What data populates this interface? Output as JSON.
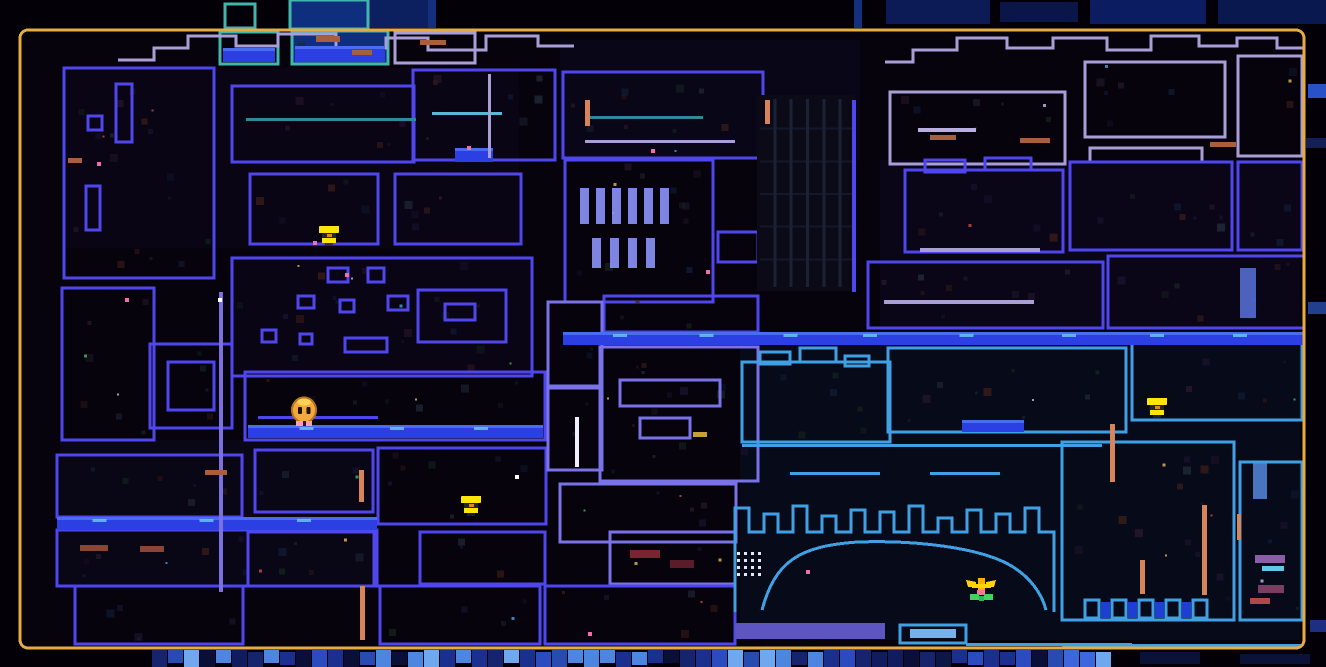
{
  "canvas": {
    "w": 1326,
    "h": 667,
    "bg_outside": "#030107",
    "bg_inside": "#07030d"
  },
  "frame": {
    "x": 20,
    "y": 30,
    "w": 1284,
    "h": 618,
    "radius": 8,
    "color": "#e7ac3f",
    "thickness": 3
  },
  "palette": {
    "b": "#4f46ee",
    "v": "#7a72e8",
    "l": "#a89fd6",
    "c": "#3fa0e4",
    "t": "#42b5ad",
    "water": "#2336d8",
    "water_band": "#2b3fe2",
    "sparkle": "#6fd4f0",
    "pipe": "#d8845a",
    "white_line": "#eef0ff",
    "purple_line": "#7a70e0"
  },
  "washes": [
    {
      "x": 560,
      "y": 40,
      "w": 300,
      "h": 120,
      "c": "#0a0a20",
      "o": 0.55
    },
    {
      "x": 880,
      "y": 160,
      "w": 420,
      "h": 170,
      "c": "#0c0a22",
      "o": 0.55
    },
    {
      "x": 60,
      "y": 440,
      "w": 320,
      "h": 150,
      "c": "#0c0a20",
      "o": 0.5
    },
    {
      "x": 740,
      "y": 345,
      "w": 560,
      "h": 295,
      "c": "#081024",
      "o": 0.55
    },
    {
      "x": 230,
      "y": 255,
      "w": 300,
      "h": 120,
      "c": "#0b081e",
      "o": 0.5
    },
    {
      "x": 64,
      "y": 68,
      "w": 455,
      "h": 180,
      "c": "#0b071c",
      "o": 0.5
    }
  ],
  "rooms": [
    {
      "x": 64,
      "y": 68,
      "w": 150,
      "h": 210,
      "c": "b"
    },
    {
      "x": 116,
      "y": 84,
      "w": 16,
      "h": 58,
      "c": "b"
    },
    {
      "x": 88,
      "y": 116,
      "w": 14,
      "h": 14,
      "c": "b"
    },
    {
      "x": 86,
      "y": 186,
      "w": 14,
      "h": 44,
      "c": "b"
    },
    {
      "x": 232,
      "y": 86,
      "w": 182,
      "h": 76,
      "c": "b"
    },
    {
      "x": 413,
      "y": 70,
      "w": 142,
      "h": 90,
      "c": "b"
    },
    {
      "x": 250,
      "y": 174,
      "w": 128,
      "h": 70,
      "c": "b"
    },
    {
      "x": 395,
      "y": 174,
      "w": 126,
      "h": 70,
      "c": "b"
    },
    {
      "x": 232,
      "y": 258,
      "w": 300,
      "h": 118,
      "c": "b"
    },
    {
      "x": 328,
      "y": 268,
      "w": 20,
      "h": 14,
      "c": "b"
    },
    {
      "x": 368,
      "y": 268,
      "w": 16,
      "h": 14,
      "c": "b"
    },
    {
      "x": 298,
      "y": 296,
      "w": 16,
      "h": 12,
      "c": "b"
    },
    {
      "x": 340,
      "y": 300,
      "w": 14,
      "h": 12,
      "c": "b"
    },
    {
      "x": 388,
      "y": 296,
      "w": 20,
      "h": 14,
      "c": "b"
    },
    {
      "x": 262,
      "y": 330,
      "w": 14,
      "h": 12,
      "c": "b"
    },
    {
      "x": 300,
      "y": 334,
      "w": 12,
      "h": 10,
      "c": "b"
    },
    {
      "x": 345,
      "y": 338,
      "w": 42,
      "h": 14,
      "c": "b"
    },
    {
      "x": 418,
      "y": 290,
      "w": 88,
      "h": 52,
      "c": "b"
    },
    {
      "x": 445,
      "y": 304,
      "w": 30,
      "h": 16,
      "c": "b"
    },
    {
      "x": 150,
      "y": 344,
      "w": 82,
      "h": 84,
      "c": "b"
    },
    {
      "x": 168,
      "y": 362,
      "w": 46,
      "h": 48,
      "c": "b"
    },
    {
      "x": 62,
      "y": 288,
      "w": 92,
      "h": 152,
      "c": "b"
    },
    {
      "x": 57,
      "y": 455,
      "w": 185,
      "h": 62,
      "c": "b"
    },
    {
      "x": 57,
      "y": 530,
      "w": 320,
      "h": 56,
      "c": "b"
    },
    {
      "x": 75,
      "y": 586,
      "w": 168,
      "h": 58,
      "c": "b"
    },
    {
      "x": 245,
      "y": 372,
      "w": 300,
      "h": 68,
      "c": "b"
    },
    {
      "x": 255,
      "y": 450,
      "w": 118,
      "h": 62,
      "c": "b"
    },
    {
      "x": 378,
      "y": 448,
      "w": 168,
      "h": 76,
      "c": "b"
    },
    {
      "x": 248,
      "y": 532,
      "w": 126,
      "h": 54,
      "c": "b"
    },
    {
      "x": 420,
      "y": 532,
      "w": 125,
      "h": 52,
      "c": "b"
    },
    {
      "x": 610,
      "y": 532,
      "w": 125,
      "h": 52,
      "c": "v"
    },
    {
      "x": 380,
      "y": 586,
      "w": 160,
      "h": 58,
      "c": "b"
    },
    {
      "x": 545,
      "y": 586,
      "w": 190,
      "h": 58,
      "c": "b"
    },
    {
      "x": 563,
      "y": 72,
      "w": 200,
      "h": 86,
      "c": "b"
    },
    {
      "x": 565,
      "y": 160,
      "w": 148,
      "h": 142,
      "c": "b"
    },
    {
      "x": 718,
      "y": 232,
      "w": 40,
      "h": 30,
      "c": "b"
    },
    {
      "x": 604,
      "y": 296,
      "w": 154,
      "h": 36,
      "c": "b"
    },
    {
      "x": 600,
      "y": 347,
      "w": 158,
      "h": 134,
      "c": "v"
    },
    {
      "x": 548,
      "y": 302,
      "w": 54,
      "h": 84,
      "c": "v"
    },
    {
      "x": 548,
      "y": 388,
      "w": 54,
      "h": 82,
      "c": "v"
    },
    {
      "x": 560,
      "y": 484,
      "w": 176,
      "h": 58,
      "c": "v"
    },
    {
      "x": 620,
      "y": 380,
      "w": 100,
      "h": 26,
      "c": "v"
    },
    {
      "x": 640,
      "y": 418,
      "w": 50,
      "h": 20,
      "c": "v"
    },
    {
      "x": 890,
      "y": 92,
      "w": 175,
      "h": 72,
      "c": "l"
    },
    {
      "x": 1085,
      "y": 62,
      "w": 140,
      "h": 75,
      "c": "l"
    },
    {
      "x": 1238,
      "y": 56,
      "w": 64,
      "h": 100,
      "c": "l"
    },
    {
      "x": 1090,
      "y": 148,
      "w": 112,
      "h": 14,
      "c": "l"
    },
    {
      "x": 905,
      "y": 170,
      "w": 158,
      "h": 82,
      "c": "b"
    },
    {
      "x": 925,
      "y": 160,
      "w": 40,
      "h": 12,
      "c": "b"
    },
    {
      "x": 985,
      "y": 158,
      "w": 46,
      "h": 12,
      "c": "b"
    },
    {
      "x": 1070,
      "y": 162,
      "w": 162,
      "h": 88,
      "c": "b"
    },
    {
      "x": 1238,
      "y": 162,
      "w": 64,
      "h": 88,
      "c": "b"
    },
    {
      "x": 868,
      "y": 262,
      "w": 235,
      "h": 66,
      "c": "b"
    },
    {
      "x": 1108,
      "y": 256,
      "w": 196,
      "h": 72,
      "c": "b"
    },
    {
      "x": 742,
      "y": 362,
      "w": 148,
      "h": 80,
      "c": "c"
    },
    {
      "x": 760,
      "y": 352,
      "w": 30,
      "h": 12,
      "c": "c"
    },
    {
      "x": 800,
      "y": 348,
      "w": 36,
      "h": 14,
      "c": "c"
    },
    {
      "x": 845,
      "y": 356,
      "w": 24,
      "h": 10,
      "c": "c"
    },
    {
      "x": 888,
      "y": 348,
      "w": 238,
      "h": 84,
      "c": "c"
    },
    {
      "x": 1132,
      "y": 342,
      "w": 170,
      "h": 78,
      "c": "c"
    },
    {
      "x": 1062,
      "y": 442,
      "w": 172,
      "h": 178,
      "c": "c"
    },
    {
      "x": 1240,
      "y": 462,
      "w": 62,
      "h": 158,
      "c": "c"
    },
    {
      "x": 900,
      "y": 625,
      "w": 66,
      "h": 18,
      "c": "c"
    },
    {
      "x": 220,
      "y": 32,
      "w": 58,
      "h": 32,
      "c": "t"
    },
    {
      "x": 292,
      "y": 31,
      "w": 96,
      "h": 33,
      "c": "t",
      "f": "#0f2f7d"
    },
    {
      "x": 395,
      "y": 33,
      "w": 80,
      "h": 30,
      "c": "l"
    }
  ],
  "water": [
    {
      "x": 57,
      "y": 517,
      "w": 320,
      "h": 13
    },
    {
      "x": 248,
      "y": 425,
      "w": 295,
      "h": 13
    },
    {
      "x": 563,
      "y": 332,
      "w": 740,
      "h": 13
    },
    {
      "x": 962,
      "y": 420,
      "w": 62,
      "h": 12
    },
    {
      "x": 455,
      "y": 148,
      "w": 38,
      "h": 14
    },
    {
      "x": 223,
      "y": 48,
      "w": 52,
      "h": 14
    },
    {
      "x": 295,
      "y": 46,
      "w": 90,
      "h": 16
    }
  ],
  "lines": [
    {
      "x": 246,
      "y": 118,
      "w": 170,
      "h": 3,
      "c": "#2e8a9a"
    },
    {
      "x": 585,
      "y": 116,
      "w": 118,
      "h": 3,
      "c": "#2e8a9a"
    },
    {
      "x": 585,
      "y": 140,
      "w": 150,
      "h": 3,
      "c": "l"
    },
    {
      "x": 432,
      "y": 112,
      "w": 70,
      "h": 3,
      "c": "#58b8d8"
    },
    {
      "x": 488,
      "y": 74,
      "w": 3,
      "h": 84,
      "c": "l"
    },
    {
      "x": 219,
      "y": 292,
      "w": 4,
      "h": 300,
      "c": "purple_line"
    },
    {
      "x": 575,
      "y": 417,
      "w": 4,
      "h": 50,
      "c": "white_line"
    },
    {
      "x": 852,
      "y": 100,
      "w": 4,
      "h": 192,
      "c": "b"
    },
    {
      "x": 920,
      "y": 248,
      "w": 120,
      "h": 4,
      "c": "l"
    },
    {
      "x": 884,
      "y": 300,
      "w": 150,
      "h": 4,
      "c": "l"
    },
    {
      "x": 742,
      "y": 444,
      "w": 360,
      "h": 3,
      "c": "c"
    },
    {
      "x": 790,
      "y": 472,
      "w": 90,
      "h": 3,
      "c": "c"
    },
    {
      "x": 930,
      "y": 472,
      "w": 70,
      "h": 3,
      "c": "c"
    },
    {
      "x": 966,
      "y": 643,
      "w": 166,
      "h": 3,
      "c": "c"
    },
    {
      "x": 1062,
      "y": 644,
      "w": 240,
      "h": 3,
      "c": "c"
    },
    {
      "x": 258,
      "y": 416,
      "w": 120,
      "h": 3,
      "c": "b"
    }
  ],
  "pipes": [
    {
      "x": 585,
      "y": 100,
      "w": 5,
      "h": 26
    },
    {
      "x": 765,
      "y": 100,
      "w": 5,
      "h": 24
    },
    {
      "x": 359,
      "y": 470,
      "w": 5,
      "h": 32
    },
    {
      "x": 360,
      "y": 586,
      "w": 5,
      "h": 54
    },
    {
      "x": 1110,
      "y": 424,
      "w": 5,
      "h": 58
    },
    {
      "x": 1202,
      "y": 505,
      "w": 5,
      "h": 90
    },
    {
      "x": 1140,
      "y": 560,
      "w": 5,
      "h": 34
    },
    {
      "x": 1237,
      "y": 514,
      "w": 4,
      "h": 26
    }
  ],
  "dashes": [
    {
      "x": 68,
      "y": 158,
      "w": 14,
      "h": 5,
      "c": "#a85f3f"
    },
    {
      "x": 80,
      "y": 545,
      "w": 28,
      "h": 6,
      "c": "#8a4632"
    },
    {
      "x": 140,
      "y": 546,
      "w": 24,
      "h": 6,
      "c": "#8a4632"
    },
    {
      "x": 205,
      "y": 470,
      "w": 22,
      "h": 5,
      "c": "#a85f3f"
    },
    {
      "x": 316,
      "y": 36,
      "w": 24,
      "h": 6,
      "c": "#a85f3f"
    },
    {
      "x": 352,
      "y": 50,
      "w": 20,
      "h": 5,
      "c": "#a85f3f"
    },
    {
      "x": 420,
      "y": 40,
      "w": 26,
      "h": 5,
      "c": "#a85f3f"
    },
    {
      "x": 930,
      "y": 135,
      "w": 26,
      "h": 5,
      "c": "#a85f3f"
    },
    {
      "x": 1020,
      "y": 138,
      "w": 30,
      "h": 5,
      "c": "#a85f3f"
    },
    {
      "x": 1210,
      "y": 142,
      "w": 26,
      "h": 5,
      "c": "#a85f3f"
    },
    {
      "x": 693,
      "y": 432,
      "w": 14,
      "h": 5,
      "c": "#c8a03a"
    },
    {
      "x": 918,
      "y": 128,
      "w": 58,
      "h": 4,
      "c": "#b8aee0"
    },
    {
      "x": 630,
      "y": 550,
      "w": 30,
      "h": 8,
      "c": "#7a2430"
    },
    {
      "x": 670,
      "y": 560,
      "w": 24,
      "h": 8,
      "c": "#5a1c28"
    },
    {
      "x": 1255,
      "y": 555,
      "w": 30,
      "h": 8,
      "c": "#8a5fa8"
    },
    {
      "x": 1258,
      "y": 585,
      "w": 26,
      "h": 8,
      "c": "#7a3f60"
    },
    {
      "x": 1262,
      "y": 566,
      "w": 22,
      "h": 5,
      "c": "#5fc8e8"
    },
    {
      "x": 1250,
      "y": 598,
      "w": 20,
      "h": 6,
      "c": "#b04848"
    }
  ],
  "streaks": [
    {
      "x": 1240,
      "y": 268,
      "w": 16,
      "h": 50,
      "c": "#5e79e8"
    },
    {
      "x": 1253,
      "y": 463,
      "w": 14,
      "h": 36,
      "c": "#5a8fe8"
    }
  ],
  "dots": [
    {
      "x": 97,
      "y": 162,
      "c": "#f06fa8"
    },
    {
      "x": 125,
      "y": 298,
      "c": "#f06fa8"
    },
    {
      "x": 218,
      "y": 298,
      "c": "#ffffff"
    },
    {
      "x": 345,
      "y": 273,
      "c": "#f06fa8"
    },
    {
      "x": 467,
      "y": 146,
      "c": "#f06fa8"
    },
    {
      "x": 651,
      "y": 149,
      "c": "#f06fa8"
    },
    {
      "x": 706,
      "y": 270,
      "c": "#f06fa8"
    },
    {
      "x": 515,
      "y": 475,
      "c": "#ffffff"
    },
    {
      "x": 588,
      "y": 632,
      "c": "#f06fa8"
    },
    {
      "x": 806,
      "y": 570,
      "c": "#f06fa8"
    }
  ],
  "shapes": [
    {
      "type": "path",
      "d": "M118,60 h36 v-12 h34 v-12 h48 v10 h42 v-12 h58 v14 h50 v-10 h42 v12 h58 v-14 h52 v10 h36",
      "c": "l"
    },
    {
      "type": "path",
      "d": "M885,62 h28 v-12 h44 v-12 h50 v10 h46 v-10 h54 v12 h44 v-14 h48 v10 h38 v-8 h40 v10 h30",
      "c": "l"
    },
    {
      "type": "path",
      "d": "M762,610 C775,562 798,546 858,542 C918,540 978,548 1008,564 C1030,576 1042,594 1046,610",
      "c": "c"
    },
    {
      "type": "cren",
      "x": 735,
      "y": 532,
      "count": 11,
      "tw": 14,
      "gap": 15,
      "hs": [
        24,
        18,
        26,
        16,
        22,
        20,
        26,
        14,
        22,
        18,
        24
      ],
      "down": 80,
      "c": "c"
    },
    {
      "type": "teeth",
      "x": 1085,
      "y": 600,
      "count": 5,
      "tw": 14,
      "gap": 13,
      "th": 18,
      "c": "c",
      "fill": "#1d3fd2"
    },
    {
      "type": "columns",
      "x": 757,
      "y": 95,
      "w": 98,
      "h": 196,
      "bg": "#0b0a16",
      "line": "#1b2238",
      "cols": 6,
      "rows": 6
    },
    {
      "type": "dotgrid",
      "x": 737,
      "y": 552,
      "cols": 4,
      "rows": 4,
      "cell": 7,
      "size": 3,
      "c": "#e8e8f0"
    },
    {
      "type": "bars",
      "x": 580,
      "y": 188,
      "count": 6,
      "w": 9,
      "gap": 7,
      "h": 36,
      "c": "#8c92f8"
    },
    {
      "type": "bars",
      "x": 592,
      "y": 238,
      "count": 4,
      "w": 9,
      "gap": 9,
      "h": 30,
      "c": "#8c92f8"
    },
    {
      "type": "rect",
      "x": 735,
      "y": 623,
      "w": 150,
      "h": 16,
      "f": "#5c55c2"
    },
    {
      "type": "rect",
      "x": 910,
      "y": 629,
      "w": 46,
      "h": 9,
      "f": "#7ab0e8"
    }
  ],
  "outside": {
    "top_blocks": [
      {
        "x": 350,
        "y": 0,
        "w": 80,
        "h": 28,
        "c": "#0c1f5e"
      },
      {
        "x": 428,
        "y": 0,
        "w": 8,
        "h": 28,
        "c": "#12307e"
      },
      {
        "x": 854,
        "y": 0,
        "w": 8,
        "h": 28,
        "c": "#12307e"
      },
      {
        "x": 886,
        "y": 0,
        "w": 104,
        "h": 24,
        "c": "#0c1a55"
      },
      {
        "x": 1000,
        "y": 2,
        "w": 78,
        "h": 20,
        "c": "#0a164a"
      },
      {
        "x": 1090,
        "y": 0,
        "w": 116,
        "h": 24,
        "c": "#0c1c60"
      },
      {
        "x": 1218,
        "y": 0,
        "w": 108,
        "h": 24,
        "c": "#0a1850"
      }
    ],
    "above_rooms": [
      {
        "x": 225,
        "y": 4,
        "w": 30,
        "h": 24,
        "c": "t"
      },
      {
        "x": 290,
        "y": 0,
        "w": 78,
        "h": 29,
        "c": "t",
        "f": "#0e2f7d"
      }
    ],
    "right_bits": [
      {
        "x": 1308,
        "y": 84,
        "w": 18,
        "h": 14,
        "c": "#2a52c8"
      },
      {
        "x": 1306,
        "y": 138,
        "w": 20,
        "h": 10,
        "c": "#131f56"
      },
      {
        "x": 1308,
        "y": 302,
        "w": 18,
        "h": 12,
        "c": "#20408e"
      },
      {
        "x": 1310,
        "y": 620,
        "w": 16,
        "h": 12,
        "c": "#1c2f80"
      }
    ],
    "bottom_strip": {
      "x": 152,
      "y": 650,
      "w": 956,
      "h": 17,
      "tile": 16,
      "colors": [
        "#101c5e",
        "#1b2f8e",
        "#2c4bc0",
        "#3e66dd",
        "#16246e",
        "#0d1745",
        "#4d86e0",
        "#274bb0",
        "#6fa8ee",
        "#0a0f38"
      ]
    },
    "bottom_extras": [
      {
        "x": 1140,
        "y": 652,
        "w": 60,
        "h": 12,
        "c": "#0a1238"
      },
      {
        "x": 1240,
        "y": 654,
        "w": 70,
        "h": 10,
        "c": "#0a1238"
      }
    ]
  },
  "markers": {
    "flames": [
      {
        "x": 318,
        "y": 226,
        "foot": true
      },
      {
        "x": 460,
        "y": 496,
        "foot": false
      },
      {
        "x": 1146,
        "y": 398,
        "foot": false
      }
    ],
    "flame_colors": {
      "body": "#ffe608",
      "band": "#23233a",
      "core": "#e08820",
      "foot": "#f06fa8"
    },
    "flower": {
      "x": 966,
      "y": 578
    },
    "flower_colors": {
      "petal": "#ffd400",
      "petal2": "#ffb000",
      "center": "#ff70a0",
      "leaf": "#3ed463",
      "leaf2": "#2bb84e"
    },
    "player": {
      "x": 292,
      "y": 398
    },
    "player_colors": {
      "body": "#f2a93a",
      "outline": "#b5741c",
      "eye": "#1c1208",
      "feet": "#ff9bb5",
      "gap": "#3a1020",
      "shine": "#ffd95e"
    }
  },
  "noise": {
    "seed": 987654321,
    "palette": [
      "#16281e",
      "#2c1a30",
      "#402018",
      "#11203a",
      "#1e1430",
      "#24303e"
    ],
    "bright": [
      "#3fae62",
      "#c04848",
      "#3a9fd0",
      "#c0b0e0",
      "#d8b050"
    ]
  }
}
